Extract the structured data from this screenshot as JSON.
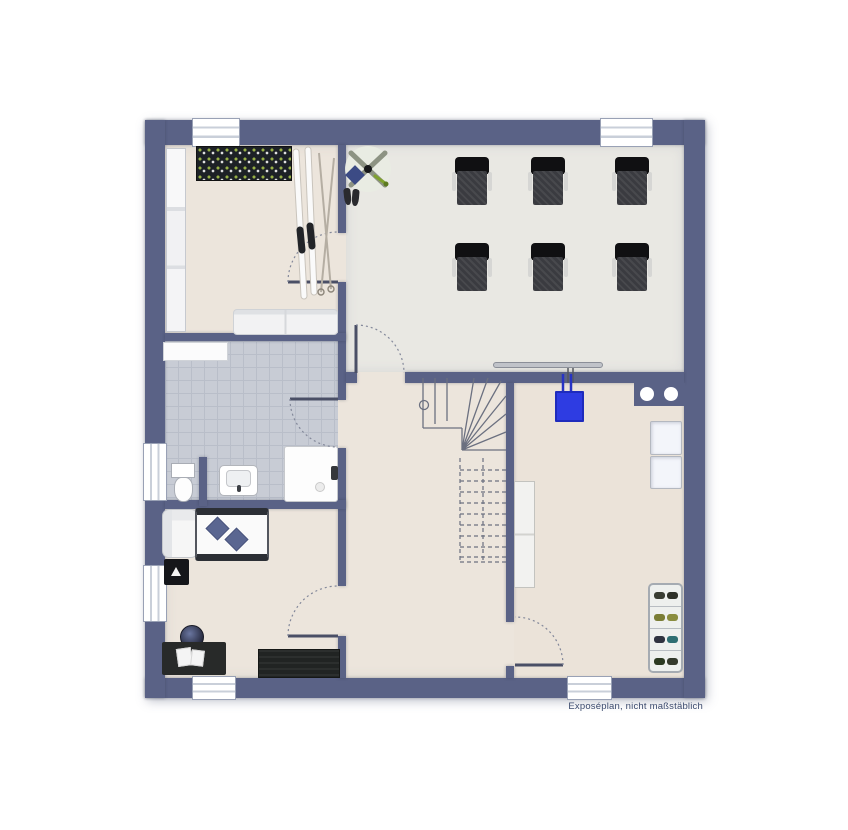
{
  "caption": "Exposéplan, nicht maßstäblich",
  "colors": {
    "background": "#ffffff",
    "wall": "#5a6286",
    "floor_main": "#ece5dc",
    "floor_office": "#e9e8e3",
    "floor_utility": "#ebe3d9",
    "floor_tile": "#c8ccd5",
    "tile_grout": "#b9bec9",
    "window": "#ffffff",
    "accent_blue": "#2e3ce2",
    "furniture_dark": "#23262a",
    "pillow_blue": "#5a6691",
    "caption_text": "#3b4a6d",
    "line": "#6b7080"
  },
  "counts": {
    "armchairs": 6,
    "windows": 6,
    "doors": 5
  },
  "rooms": [
    {
      "name": "storage-room",
      "furniture": [
        "wall-shelf",
        "wardrobe",
        "skis-and-poles",
        "sofa"
      ]
    },
    {
      "name": "office-room",
      "furniture": [
        "ceiling-fan",
        "boots",
        "six-armchairs",
        "radiator"
      ]
    },
    {
      "name": "bathroom",
      "furniture": [
        "shelf",
        "toilet",
        "washbasin",
        "shower"
      ]
    },
    {
      "name": "bedroom",
      "furniture": [
        "lounge-chair",
        "nightstand",
        "bed-with-pillows",
        "desk",
        "desk-chair",
        "sideboard"
      ]
    },
    {
      "name": "hallway",
      "furniture": [
        "winder-staircase"
      ]
    },
    {
      "name": "utility-room",
      "furniture": [
        "boiler",
        "double-basin-counter",
        "appliances",
        "tall-cabinet",
        "shoe-rack"
      ]
    }
  ]
}
